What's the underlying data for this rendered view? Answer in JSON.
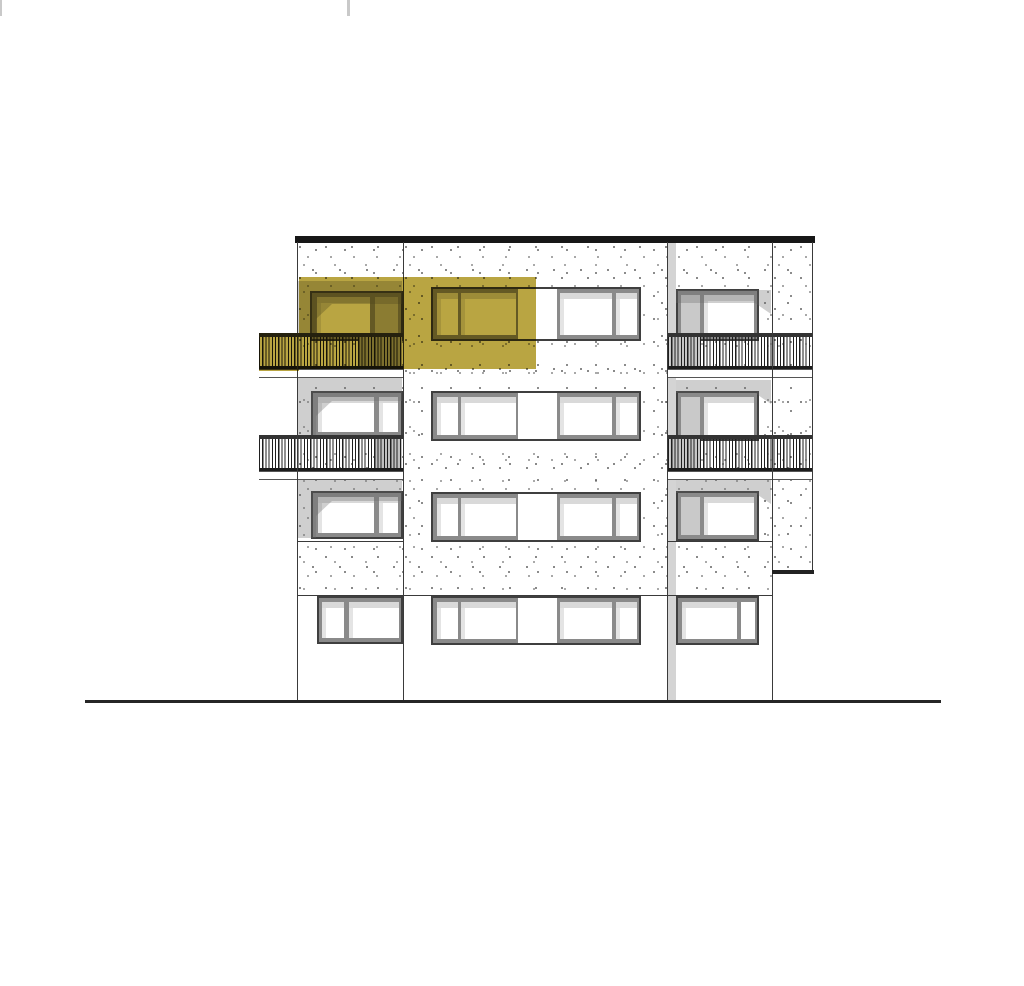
{
  "drawing": {
    "title": "building-elevation-drawing",
    "description": "Architectural south elevation of a four-storey apartment block with recessed balconies; one top-floor unit highlighted in olive-yellow",
    "canvas": {
      "width": 1024,
      "height": 986,
      "background": "#ffffff"
    },
    "colors": {
      "line": "#3a3a3a",
      "roof": "#171717",
      "ground_line": "#262626",
      "frame": "#8a8a8a",
      "frame_edge": "#3f3f3f",
      "glass": "#ffffff",
      "glass_shade": "#c9c9c9",
      "reflection": "#d9d9d9",
      "joint_shadow": "#d4d4d4",
      "railing_dark": "#1f1f1f",
      "highlight": "#b9a542",
      "stipple_dot": "#4c4c4c",
      "tick": "#c9c9c9"
    },
    "elements": [
      {
        "kind": "rect",
        "name": "page-tick-left",
        "x": 0,
        "y": 0,
        "w": 2,
        "h": 16,
        "fill": "#c9c9c9"
      },
      {
        "kind": "rect",
        "name": "page-tick-mid",
        "x": 347,
        "y": 0,
        "w": 3,
        "h": 16,
        "fill": "#c9c9c9"
      },
      {
        "kind": "stipple",
        "name": "wall-left-column",
        "x": 297,
        "y": 243,
        "w": 106,
        "h": 350
      },
      {
        "kind": "stipple",
        "name": "wall-middle-column",
        "x": 403,
        "y": 243,
        "w": 265,
        "h": 350
      },
      {
        "kind": "stipple",
        "name": "wall-right-column",
        "x": 668,
        "y": 243,
        "w": 104,
        "h": 350
      },
      {
        "kind": "stipple",
        "name": "wall-right-wing",
        "x": 772,
        "y": 243,
        "w": 40,
        "h": 327
      },
      {
        "kind": "rect",
        "name": "facade-joint-shadow-strip",
        "x": 668,
        "y": 243,
        "w": 8,
        "h": 458,
        "fill": "#d4d4d4"
      },
      {
        "kind": "window",
        "name": "window-balcony-floor4-left",
        "x": 310,
        "y": 291,
        "w": 93,
        "h": 50,
        "panes": [
          {
            "x": 317,
            "w": 53,
            "fill": "#ffffff",
            "reflect": true
          },
          {
            "x": 375,
            "w": 23,
            "fill": "#c0c0c0",
            "reflect": false
          }
        ]
      },
      {
        "kind": "window",
        "name": "window-floor3-left",
        "x": 311,
        "y": 391,
        "w": 92,
        "h": 47,
        "panes": [
          {
            "x": 318,
            "w": 56,
            "fill": "#ffffff",
            "reflect": true
          },
          {
            "x": 379,
            "w": 19,
            "fill": "#ffffff",
            "reflect": true
          }
        ]
      },
      {
        "kind": "window",
        "name": "window-floor2-left",
        "x": 311,
        "y": 491,
        "w": 92,
        "h": 48,
        "panes": [
          {
            "x": 318,
            "w": 56,
            "fill": "#ffffff",
            "reflect": true
          },
          {
            "x": 379,
            "w": 19,
            "fill": "#ffffff",
            "reflect": true
          }
        ]
      },
      {
        "kind": "window",
        "name": "window-ground-left",
        "x": 317,
        "y": 596,
        "w": 86,
        "h": 48,
        "panes": [
          {
            "x": 322,
            "w": 22,
            "fill": "#ffffff",
            "reflect": true
          },
          {
            "x": 349,
            "w": 50,
            "fill": "#ffffff",
            "reflect": true
          }
        ]
      },
      {
        "kind": "window",
        "name": "window-band-floor4-middle",
        "x": 431,
        "y": 287,
        "w": 210,
        "h": 54,
        "panes": [
          {
            "x": 437,
            "w": 21,
            "fill": "#ffffff",
            "reflect": true
          },
          {
            "x": 461,
            "w": 55,
            "fill": "#ffffff",
            "reflect": true
          },
          {
            "x": 518,
            "w": 39,
            "fill": "#ffffff",
            "full": true
          },
          {
            "x": 560,
            "w": 52,
            "fill": "#ffffff",
            "reflect": true
          },
          {
            "x": 616,
            "w": 21,
            "fill": "#ffffff",
            "reflect": true
          }
        ]
      },
      {
        "kind": "window",
        "name": "window-band-floor3-middle",
        "x": 431,
        "y": 391,
        "w": 210,
        "h": 50,
        "panes": [
          {
            "x": 437,
            "w": 21,
            "fill": "#ffffff",
            "reflect": true
          },
          {
            "x": 461,
            "w": 55,
            "fill": "#ffffff",
            "reflect": true
          },
          {
            "x": 518,
            "w": 39,
            "fill": "#ffffff",
            "full": true
          },
          {
            "x": 560,
            "w": 52,
            "fill": "#ffffff",
            "reflect": true
          },
          {
            "x": 616,
            "w": 21,
            "fill": "#ffffff",
            "reflect": true
          }
        ]
      },
      {
        "kind": "window",
        "name": "window-band-floor2-middle",
        "x": 431,
        "y": 492,
        "w": 210,
        "h": 50,
        "panes": [
          {
            "x": 437,
            "w": 21,
            "fill": "#ffffff",
            "reflect": true
          },
          {
            "x": 461,
            "w": 55,
            "fill": "#ffffff",
            "reflect": true
          },
          {
            "x": 518,
            "w": 39,
            "fill": "#ffffff",
            "full": true
          },
          {
            "x": 560,
            "w": 52,
            "fill": "#ffffff",
            "reflect": true
          },
          {
            "x": 616,
            "w": 21,
            "fill": "#ffffff",
            "reflect": true
          }
        ]
      },
      {
        "kind": "window",
        "name": "window-band-ground-middle",
        "x": 431,
        "y": 596,
        "w": 210,
        "h": 49,
        "panes": [
          {
            "x": 437,
            "w": 21,
            "fill": "#ffffff",
            "reflect": true
          },
          {
            "x": 461,
            "w": 55,
            "fill": "#ffffff",
            "reflect": true
          },
          {
            "x": 518,
            "w": 39,
            "fill": "#ffffff",
            "full": true
          },
          {
            "x": 560,
            "w": 52,
            "fill": "#ffffff",
            "reflect": true
          },
          {
            "x": 616,
            "w": 21,
            "fill": "#ffffff",
            "reflect": true
          }
        ]
      },
      {
        "kind": "window",
        "name": "window-balcony-floor4-right",
        "x": 676,
        "y": 289,
        "w": 83,
        "h": 52,
        "panes": [
          {
            "x": 681,
            "w": 19,
            "fill": "#c9c9c9",
            "reflect": false
          },
          {
            "x": 704,
            "w": 50,
            "fill": "#ffffff",
            "reflect": true
          }
        ]
      },
      {
        "kind": "window",
        "name": "window-balcony-floor3-right",
        "x": 676,
        "y": 391,
        "w": 83,
        "h": 50,
        "panes": [
          {
            "x": 681,
            "w": 19,
            "fill": "#c9c9c9",
            "reflect": false
          },
          {
            "x": 704,
            "w": 50,
            "fill": "#ffffff",
            "reflect": true
          }
        ]
      },
      {
        "kind": "window",
        "name": "window-balcony-floor2-right",
        "x": 676,
        "y": 491,
        "w": 83,
        "h": 50,
        "panes": [
          {
            "x": 681,
            "w": 19,
            "fill": "#c9c9c9",
            "reflect": false
          },
          {
            "x": 704,
            "w": 50,
            "fill": "#ffffff",
            "reflect": true
          }
        ]
      },
      {
        "kind": "window",
        "name": "window-ground-right",
        "x": 676,
        "y": 596,
        "w": 83,
        "h": 49,
        "panes": [
          {
            "x": 682,
            "w": 55,
            "fill": "#ffffff",
            "reflect": true
          },
          {
            "x": 741,
            "w": 14,
            "fill": "#ffffff",
            "reflect": false
          }
        ]
      },
      {
        "kind": "soffit",
        "name": "balcony-soffit-shadow-floor4-left",
        "x": 298,
        "y": 281,
        "w": 104,
        "h": 53,
        "clip": "polygon(0 0,100% 0,100% 23px,34px 23px,18px 38px,18px 100%,0 100%)"
      },
      {
        "kind": "soffit",
        "name": "balcony-soffit-shadow-floor3-left",
        "x": 298,
        "y": 378,
        "w": 104,
        "h": 60,
        "clip": "polygon(0 0,100% 0,100% 23px,34px 23px,18px 38px,18px 100%,0 100%)"
      },
      {
        "kind": "soffit",
        "name": "balcony-soffit-shadow-floor2-left",
        "x": 298,
        "y": 478,
        "w": 104,
        "h": 60,
        "clip": "polygon(0 0,100% 0,100% 23px,34px 23px,18px 38px,18px 100%,0 100%)"
      },
      {
        "kind": "soffit",
        "name": "balcony-soffit-shadow-floor4-right",
        "x": 676,
        "y": 290,
        "w": 95,
        "h": 24,
        "clip": "polygon(0 0,100% 0,100% 100%,79px 13px,0 13px)"
      },
      {
        "kind": "soffit",
        "name": "balcony-soffit-shadow-floor3-right",
        "x": 676,
        "y": 380,
        "w": 95,
        "h": 24,
        "clip": "polygon(0 0,100% 0,100% 100%,79px 13px,0 13px)"
      },
      {
        "kind": "soffit",
        "name": "balcony-soffit-shadow-floor2-right",
        "x": 676,
        "y": 480,
        "w": 95,
        "h": 24,
        "clip": "polygon(0 0,100% 0,100% 100%,79px 13px,0 13px)"
      },
      {
        "kind": "rect",
        "name": "glazing-behind-railing-floor4-left",
        "x": 358,
        "y": 334,
        "w": 44,
        "h": 35,
        "fill": "#ababab"
      },
      {
        "kind": "rect",
        "name": "glazing-behind-railing-floor3-left",
        "x": 375,
        "y": 436,
        "w": 27,
        "h": 35,
        "fill": "#c0c0c0"
      },
      {
        "kind": "rect",
        "name": "recess-behind-railing-floor4-right",
        "x": 670,
        "y": 334,
        "w": 30,
        "h": 35,
        "fill": "#c6c6c6"
      },
      {
        "kind": "rect",
        "name": "recess-behind-railing-floor3-right",
        "x": 670,
        "y": 436,
        "w": 30,
        "h": 35,
        "fill": "#c6c6c6"
      },
      {
        "kind": "railing",
        "name": "balcony-railing-floor4-left",
        "x": 259,
        "y": 333,
        "w": 144,
        "h": 36
      },
      {
        "kind": "railing",
        "name": "balcony-railing-floor3-left",
        "x": 259,
        "y": 435,
        "w": 144,
        "h": 36
      },
      {
        "kind": "railing",
        "name": "balcony-railing-floor4-right",
        "x": 668,
        "y": 333,
        "w": 145,
        "h": 36
      },
      {
        "kind": "railing",
        "name": "balcony-railing-floor3-right",
        "x": 668,
        "y": 435,
        "w": 145,
        "h": 36
      },
      {
        "kind": "slab",
        "name": "balcony-slab-floor4-left",
        "x": 259,
        "y": 369,
        "w": 144,
        "h": 9
      },
      {
        "kind": "slab",
        "name": "balcony-slab-floor3-left",
        "x": 259,
        "y": 471,
        "w": 144,
        "h": 9
      },
      {
        "kind": "slab",
        "name": "balcony-slab-floor4-right",
        "x": 668,
        "y": 369,
        "w": 145,
        "h": 9
      },
      {
        "kind": "slab",
        "name": "balcony-slab-floor3-right",
        "x": 668,
        "y": 471,
        "w": 145,
        "h": 9
      },
      {
        "kind": "rect",
        "name": "roof-parapet-line",
        "x": 295,
        "y": 236,
        "w": 520,
        "h": 7,
        "fill": "#171717"
      },
      {
        "kind": "vline",
        "name": "facade-edge-left",
        "x": 297,
        "y": 242,
        "h": 459
      },
      {
        "kind": "vline",
        "name": "facade-joint-1",
        "x": 403,
        "y": 242,
        "h": 459
      },
      {
        "kind": "vline",
        "name": "facade-joint-2",
        "x": 667,
        "y": 242,
        "h": 459
      },
      {
        "kind": "vline",
        "name": "facade-joint-3",
        "x": 772,
        "y": 242,
        "h": 459
      },
      {
        "kind": "vline",
        "name": "facade-edge-right-wing",
        "x": 812,
        "y": 242,
        "h": 330
      },
      {
        "kind": "hline",
        "name": "floor2-sill-line-left",
        "x": 297,
        "y": 541,
        "w": 106
      },
      {
        "kind": "hline",
        "name": "floor2-sill-line-right",
        "x": 668,
        "y": 541,
        "w": 104
      },
      {
        "kind": "hline",
        "name": "ground-floor-lintel-line",
        "x": 297,
        "y": 595,
        "w": 475
      },
      {
        "kind": "rect",
        "name": "right-wing-bottom-edge",
        "x": 772,
        "y": 570,
        "w": 42,
        "h": 4,
        "fill": "#222222"
      },
      {
        "kind": "highlight",
        "name": "selected-unit-highlight-main",
        "x": 299,
        "y": 277,
        "w": 237,
        "h": 92
      },
      {
        "kind": "highlight",
        "name": "selected-unit-highlight-railing",
        "x": 259,
        "y": 333,
        "w": 40,
        "h": 38
      },
      {
        "kind": "rect",
        "name": "ground-line",
        "x": 85,
        "y": 700,
        "w": 856,
        "h": 3,
        "fill": "#262626"
      }
    ]
  }
}
